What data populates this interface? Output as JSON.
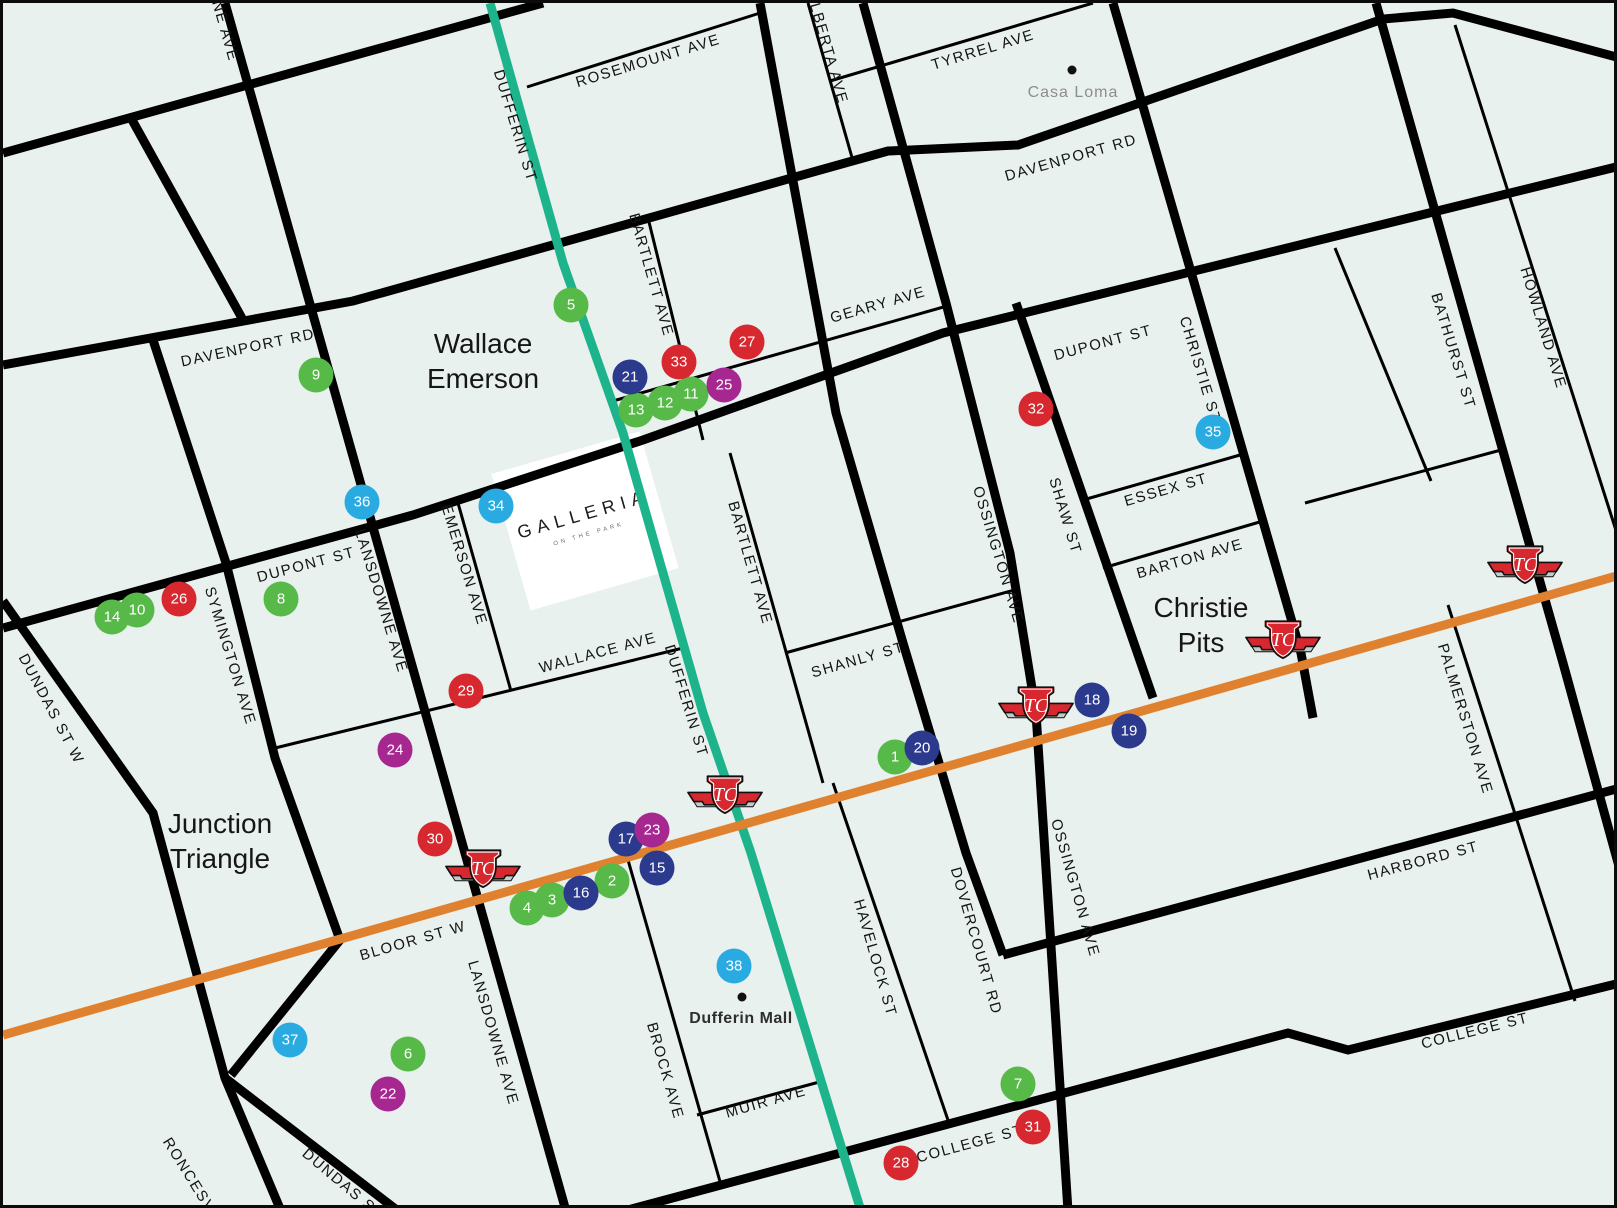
{
  "map": {
    "palette": {
      "background": "#e9f1ee",
      "road": "#000000",
      "subway_teal": "#1db48c",
      "subway_orange": "#e0812f",
      "green": "#56b948",
      "navy": "#2c3a8d",
      "red": "#d7282f",
      "purple": "#a62790",
      "cyan": "#29abe2",
      "marker_text": "#ffffff",
      "ttc_red": "#d7282f"
    },
    "galleria": {
      "title": "GALLERIA",
      "subtitle": "ON THE PARK",
      "x": 582,
      "y": 518
    },
    "neighborhoods": [
      {
        "lines": [
          "Wallace",
          "Emerson"
        ],
        "x": 480,
        "y": 358
      },
      {
        "lines": [
          "Junction",
          "Triangle"
        ],
        "x": 217,
        "y": 838
      },
      {
        "lines": [
          "Christie",
          "Pits"
        ],
        "x": 1198,
        "y": 622
      }
    ],
    "places": [
      {
        "label": "Casa Loma",
        "style": "muted",
        "x": 1070,
        "y": 90,
        "dot_x": 1069,
        "dot_y": 67
      },
      {
        "label": "Dufferin Mall",
        "style": "bold",
        "x": 738,
        "y": 1016,
        "dot_x": 739,
        "dot_y": 994
      }
    ],
    "street_labels": [
      {
        "t": "NE AVE",
        "x": 222,
        "y": 28,
        "r": 74
      },
      {
        "t": "ROSEMOUNT AVE",
        "x": 645,
        "y": 58,
        "r": -17
      },
      {
        "t": "DUFFERIN ST",
        "x": 512,
        "y": 123,
        "r": 73
      },
      {
        "t": "ALBERTA AVE",
        "x": 824,
        "y": 45,
        "r": 74
      },
      {
        "t": "TYRREL AVE",
        "x": 980,
        "y": 47,
        "r": -17
      },
      {
        "t": "DAVENPORT RD",
        "x": 1068,
        "y": 155,
        "r": -16
      },
      {
        "t": "DAVENPORT RD",
        "x": 245,
        "y": 345,
        "r": -12
      },
      {
        "t": "BARTLETT AVE",
        "x": 648,
        "y": 272,
        "r": 74
      },
      {
        "t": "GEARY AVE",
        "x": 875,
        "y": 302,
        "r": -16
      },
      {
        "t": "DUPONT ST",
        "x": 1100,
        "y": 340,
        "r": -15
      },
      {
        "t": "CHRISTIE ST",
        "x": 1197,
        "y": 367,
        "r": 73
      },
      {
        "t": "BATHURST ST",
        "x": 1450,
        "y": 348,
        "r": 73
      },
      {
        "t": "HOWLAND AVE",
        "x": 1540,
        "y": 325,
        "r": 73
      },
      {
        "t": "ESSEX ST",
        "x": 1163,
        "y": 487,
        "r": -16
      },
      {
        "t": "BARTON AVE",
        "x": 1187,
        "y": 556,
        "r": -16
      },
      {
        "t": "SHAW ST",
        "x": 1062,
        "y": 513,
        "r": 73
      },
      {
        "t": "OSSINGTON AVE",
        "x": 995,
        "y": 552,
        "r": 73
      },
      {
        "t": "DUPONT ST",
        "x": 303,
        "y": 562,
        "r": -15
      },
      {
        "t": "LANSDOWNE AVE",
        "x": 378,
        "y": 598,
        "r": 73
      },
      {
        "t": "EMERSON AVE",
        "x": 461,
        "y": 562,
        "r": 73
      },
      {
        "t": "SYMINGTON AVE",
        "x": 227,
        "y": 653,
        "r": 73
      },
      {
        "t": "DUNDAS ST W",
        "x": 48,
        "y": 706,
        "r": 62
      },
      {
        "t": "WALLACE AVE",
        "x": 595,
        "y": 650,
        "r": -15
      },
      {
        "t": "DUFFERIN ST",
        "x": 683,
        "y": 698,
        "r": 73
      },
      {
        "t": "SHANLY ST",
        "x": 855,
        "y": 657,
        "r": -16
      },
      {
        "t": "BARTLETT AVE",
        "x": 747,
        "y": 560,
        "r": 74
      },
      {
        "t": "BLOOR ST W",
        "x": 410,
        "y": 938,
        "r": -16
      },
      {
        "t": "HAVELOCK ST",
        "x": 872,
        "y": 955,
        "r": 74
      },
      {
        "t": "DOVERCOURT RD",
        "x": 973,
        "y": 938,
        "r": 74
      },
      {
        "t": "OSSINGTON AVE",
        "x": 1072,
        "y": 885,
        "r": 74
      },
      {
        "t": "BROCK AVE",
        "x": 662,
        "y": 1068,
        "r": 74
      },
      {
        "t": "MUIR AVE",
        "x": 763,
        "y": 1099,
        "r": -16
      },
      {
        "t": "LANSDOWNE AVE",
        "x": 490,
        "y": 1030,
        "r": 74
      },
      {
        "t": "HARBORD ST",
        "x": 1420,
        "y": 858,
        "r": -15
      },
      {
        "t": "PALMERSTON AVE",
        "x": 1462,
        "y": 716,
        "r": 73
      },
      {
        "t": "COLLEGE ST",
        "x": 967,
        "y": 1141,
        "r": -15
      },
      {
        "t": "COLLEGE ST",
        "x": 1472,
        "y": 1028,
        "r": -14
      },
      {
        "t": "RONCESVALLES",
        "x": 200,
        "y": 1195,
        "r": 58
      },
      {
        "t": "DUNDAS ST W",
        "x": 348,
        "y": 1188,
        "r": 40
      }
    ],
    "markers": [
      {
        "n": "1",
        "x": 892,
        "y": 754,
        "c": "green"
      },
      {
        "n": "2",
        "x": 609,
        "y": 878,
        "c": "green"
      },
      {
        "n": "3",
        "x": 549,
        "y": 897,
        "c": "green"
      },
      {
        "n": "4",
        "x": 524,
        "y": 905,
        "c": "green"
      },
      {
        "n": "5",
        "x": 568,
        "y": 302,
        "c": "green"
      },
      {
        "n": "6",
        "x": 405,
        "y": 1051,
        "c": "green"
      },
      {
        "n": "7",
        "x": 1015,
        "y": 1081,
        "c": "green"
      },
      {
        "n": "8",
        "x": 278,
        "y": 596,
        "c": "green"
      },
      {
        "n": "9",
        "x": 313,
        "y": 372,
        "c": "green"
      },
      {
        "n": "10",
        "x": 134,
        "y": 607,
        "c": "green"
      },
      {
        "n": "11",
        "x": 688,
        "y": 391,
        "c": "green"
      },
      {
        "n": "12",
        "x": 662,
        "y": 400,
        "c": "green"
      },
      {
        "n": "13",
        "x": 633,
        "y": 407,
        "c": "green"
      },
      {
        "n": "14",
        "x": 109,
        "y": 614,
        "c": "green"
      },
      {
        "n": "15",
        "x": 654,
        "y": 865,
        "c": "navy"
      },
      {
        "n": "16",
        "x": 578,
        "y": 890,
        "c": "navy"
      },
      {
        "n": "17",
        "x": 623,
        "y": 836,
        "c": "navy"
      },
      {
        "n": "18",
        "x": 1089,
        "y": 697,
        "c": "navy"
      },
      {
        "n": "19",
        "x": 1126,
        "y": 728,
        "c": "navy"
      },
      {
        "n": "20",
        "x": 919,
        "y": 745,
        "c": "navy"
      },
      {
        "n": "21",
        "x": 627,
        "y": 374,
        "c": "navy"
      },
      {
        "n": "22",
        "x": 385,
        "y": 1091,
        "c": "purple"
      },
      {
        "n": "23",
        "x": 649,
        "y": 827,
        "c": "purple"
      },
      {
        "n": "24",
        "x": 392,
        "y": 747,
        "c": "purple"
      },
      {
        "n": "25",
        "x": 721,
        "y": 382,
        "c": "purple"
      },
      {
        "n": "26",
        "x": 176,
        "y": 596,
        "c": "red"
      },
      {
        "n": "27",
        "x": 744,
        "y": 339,
        "c": "red"
      },
      {
        "n": "28",
        "x": 898,
        "y": 1160,
        "c": "red"
      },
      {
        "n": "29",
        "x": 463,
        "y": 688,
        "c": "red"
      },
      {
        "n": "30",
        "x": 432,
        "y": 836,
        "c": "red"
      },
      {
        "n": "31",
        "x": 1030,
        "y": 1124,
        "c": "red"
      },
      {
        "n": "32",
        "x": 1033,
        "y": 406,
        "c": "red"
      },
      {
        "n": "33",
        "x": 676,
        "y": 359,
        "c": "red"
      },
      {
        "n": "34",
        "x": 493,
        "y": 503,
        "c": "cyan"
      },
      {
        "n": "35",
        "x": 1210,
        "y": 429,
        "c": "cyan"
      },
      {
        "n": "36",
        "x": 359,
        "y": 499,
        "c": "cyan"
      },
      {
        "n": "37",
        "x": 287,
        "y": 1037,
        "c": "cyan"
      },
      {
        "n": "38",
        "x": 731,
        "y": 963,
        "c": "cyan"
      }
    ],
    "stations": [
      {
        "x": 480,
        "y": 866
      },
      {
        "x": 722,
        "y": 792
      },
      {
        "x": 1033,
        "y": 703
      },
      {
        "x": 1280,
        "y": 637
      },
      {
        "x": 1522,
        "y": 562
      }
    ]
  }
}
